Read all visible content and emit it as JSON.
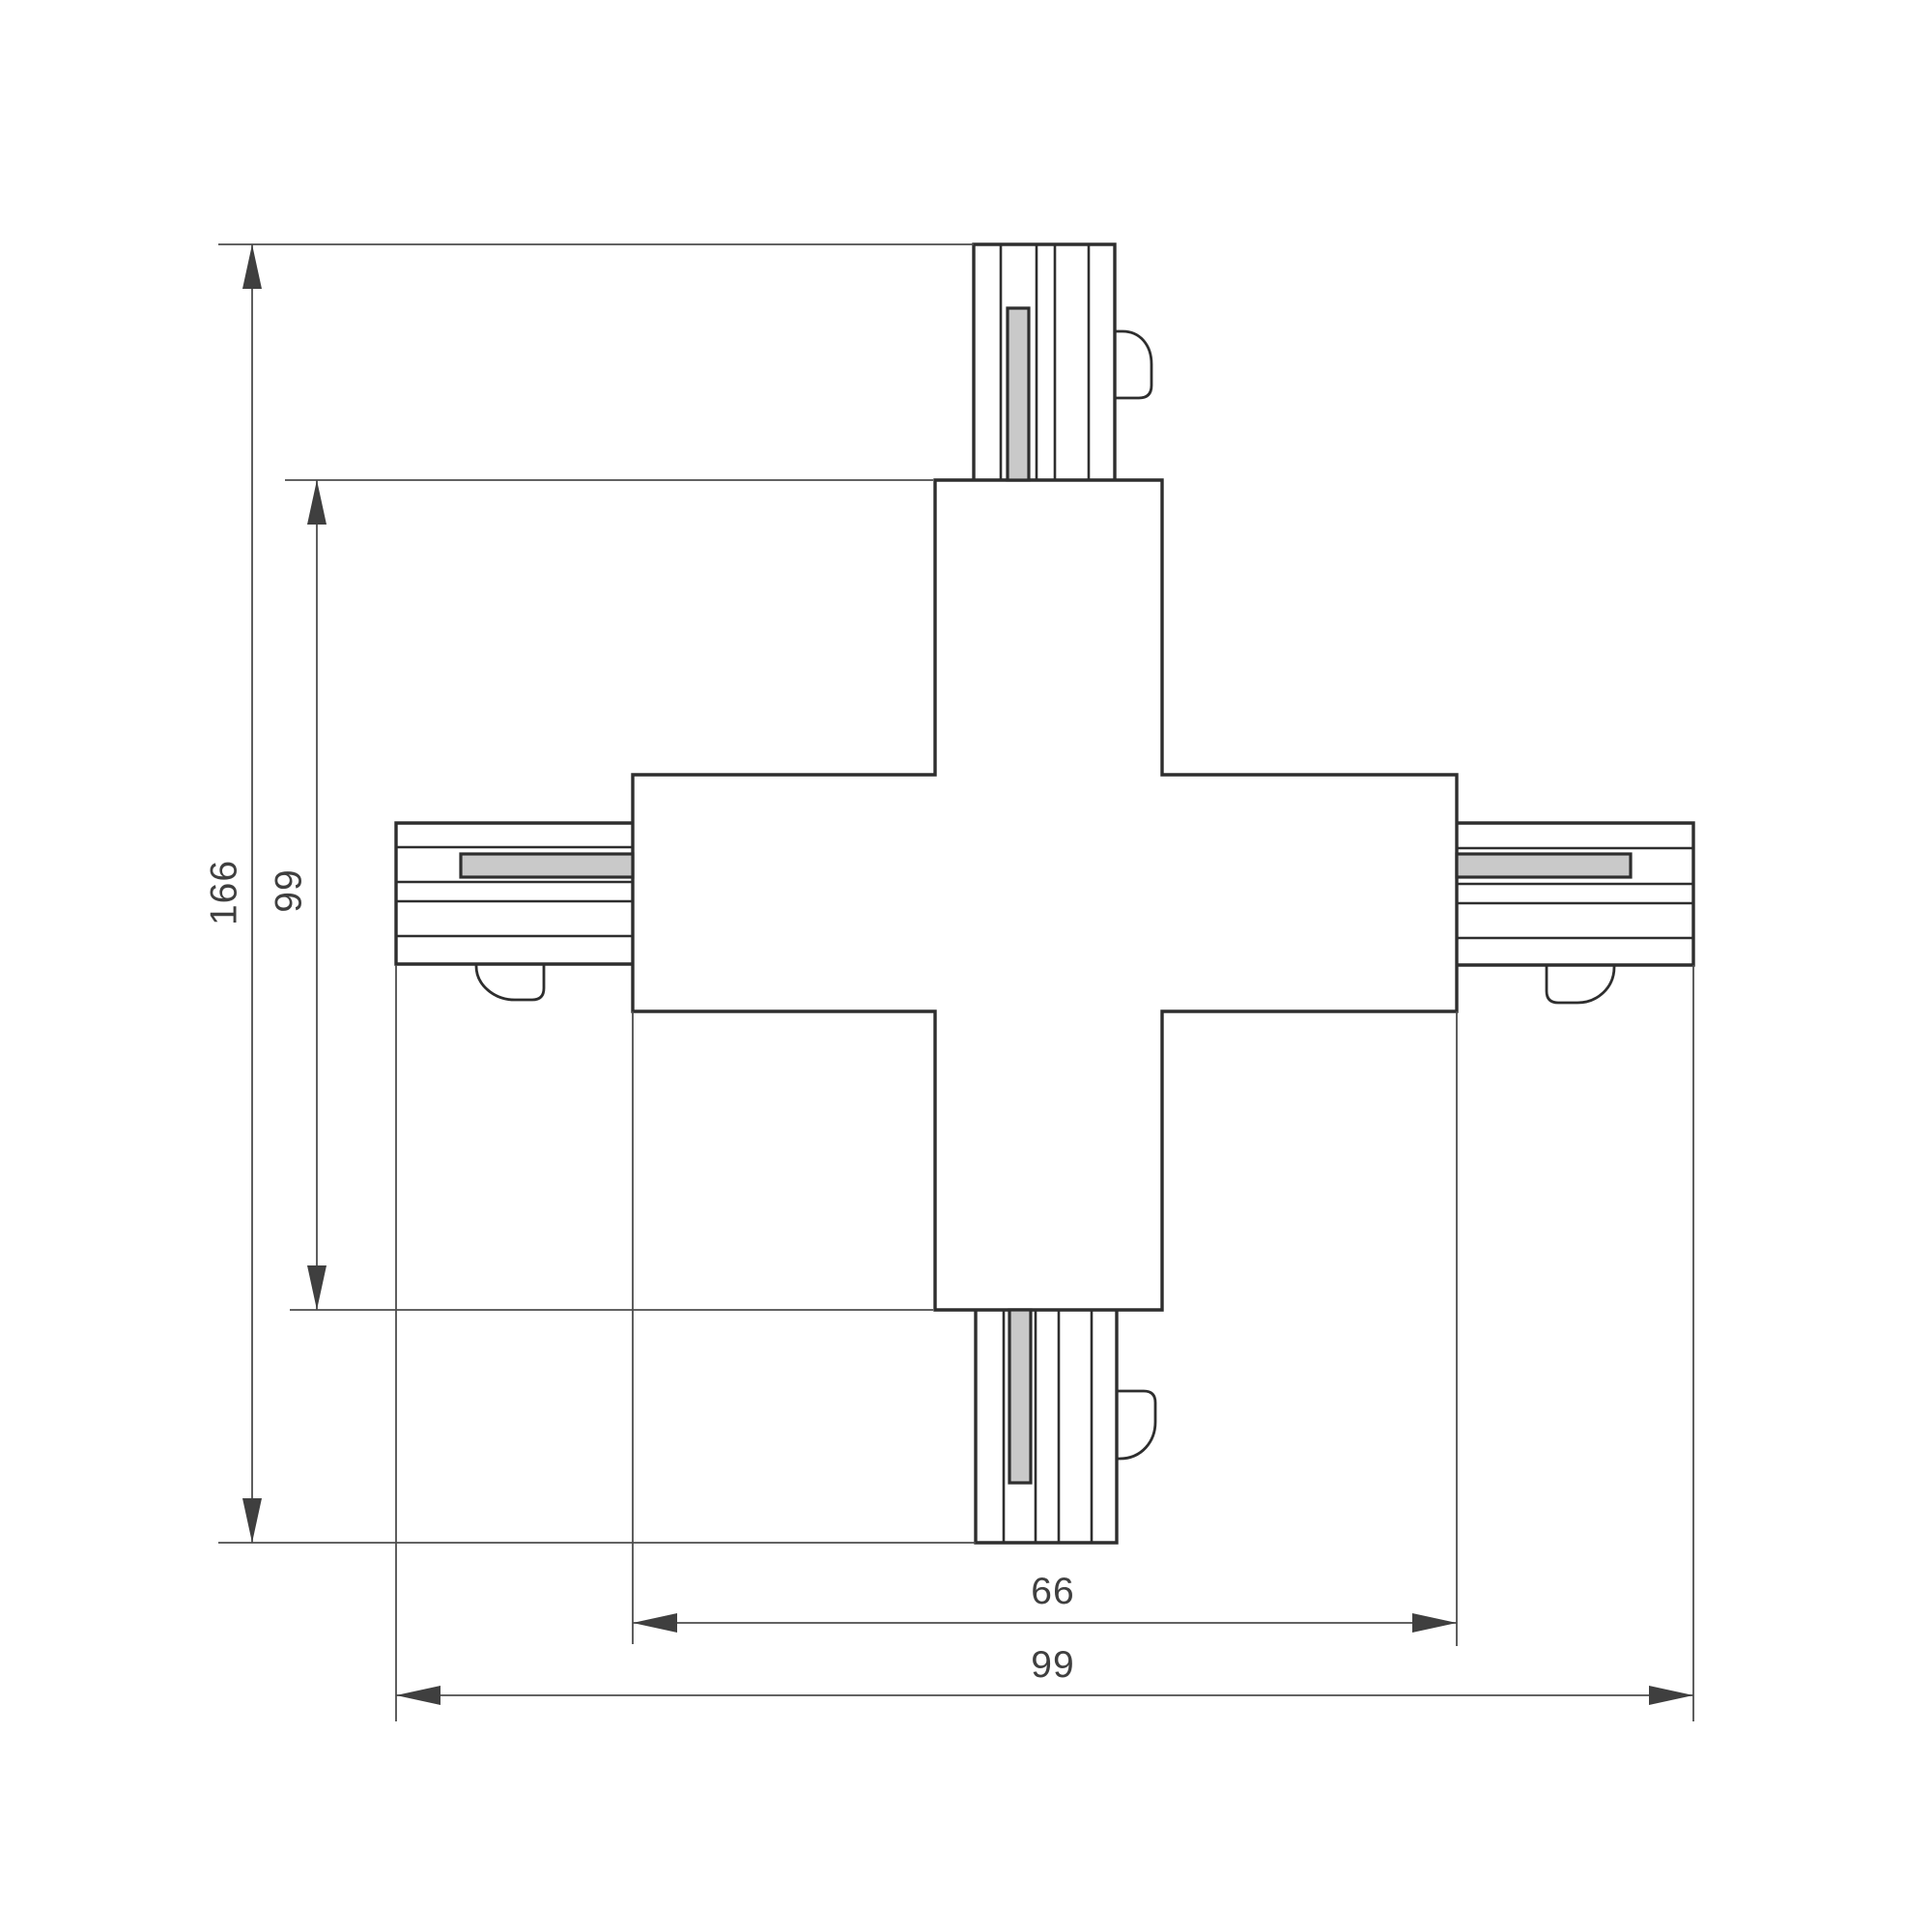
{
  "drawing": {
    "description": "x-track-connector-dimension-drawing",
    "dimensions": {
      "overall_height": "166",
      "body_height": "99",
      "body_width": "66",
      "overall_width": "99"
    },
    "colors": {
      "outline": "#2e2e2e",
      "dimension_lines": "#4d4d4d",
      "label_text": "#3f3f3f",
      "contact_bar_fill": "#c9c9c9",
      "background": "#ffffff"
    }
  }
}
